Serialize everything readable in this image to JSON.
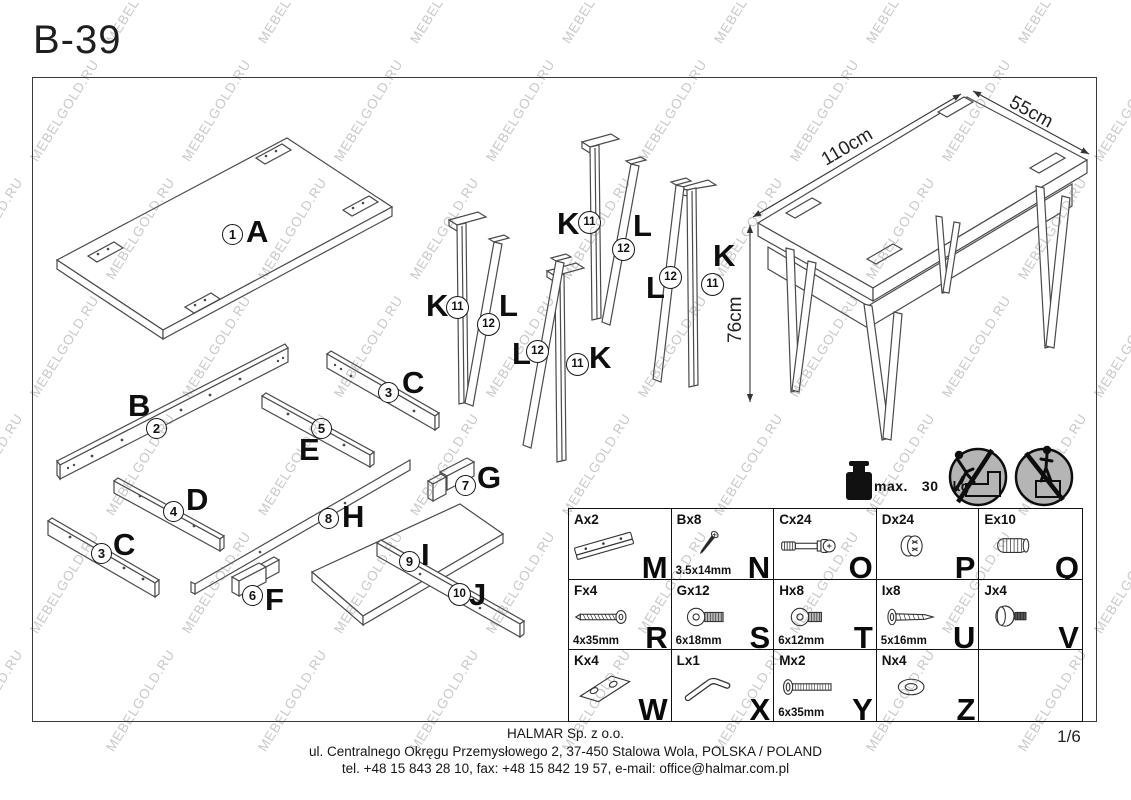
{
  "title": "B-39",
  "page_number": "1/6",
  "watermark_text": "MEBELGOLD.RU",
  "assembled_view": {
    "width_label": "110cm",
    "depth_label": "55cm",
    "height_label": "76cm"
  },
  "weight_limit": {
    "prefix": "max.",
    "value": "30",
    "unit": "kg"
  },
  "part_labels": [
    {
      "letter": "A",
      "number": "1"
    },
    {
      "letter": "B",
      "number": "2"
    },
    {
      "letter": "C",
      "number": "3"
    },
    {
      "letter": "C",
      "number": "3"
    },
    {
      "letter": "D",
      "number": "4"
    },
    {
      "letter": "E",
      "number": "5"
    },
    {
      "letter": "F",
      "number": "6"
    },
    {
      "letter": "G",
      "number": "7"
    },
    {
      "letter": "H",
      "number": "8"
    },
    {
      "letter": "I",
      "number": "9"
    },
    {
      "letter": "J",
      "number": "10"
    },
    {
      "letter": "K",
      "number": "11"
    },
    {
      "letter": "L",
      "number": "12"
    },
    {
      "letter": "L",
      "number": "12"
    },
    {
      "letter": "K",
      "number": "11"
    },
    {
      "letter": "K",
      "number": "11"
    },
    {
      "letter": "L",
      "number": "12"
    },
    {
      "letter": "L",
      "number": "12"
    },
    {
      "letter": "K",
      "number": "11"
    }
  ],
  "hardware": {
    "cells": [
      {
        "code": "Ax2",
        "size": "",
        "letter": "M",
        "icon": "drawer-slide-icon"
      },
      {
        "code": "Bx8",
        "size": "3.5x14mm",
        "letter": "N",
        "icon": "screw-small-icon"
      },
      {
        "code": "Cx24",
        "size": "",
        "letter": "O",
        "icon": "cam-bolt-icon"
      },
      {
        "code": "Dx24",
        "size": "",
        "letter": "P",
        "icon": "cam-lock-icon"
      },
      {
        "code": "Ex10",
        "size": "",
        "letter": "Q",
        "icon": "dowel-icon"
      },
      {
        "code": "Fx4",
        "size": "4x35mm",
        "letter": "R",
        "icon": "screw-long-icon"
      },
      {
        "code": "Gx12",
        "size": "6x18mm",
        "letter": "S",
        "icon": "flange-bolt-icon"
      },
      {
        "code": "Hx8",
        "size": "6x12mm",
        "letter": "T",
        "icon": "flange-bolt-short-icon"
      },
      {
        "code": "Ix8",
        "size": "5x16mm",
        "letter": "U",
        "icon": "pan-screw-icon"
      },
      {
        "code": "Jx4",
        "size": "",
        "letter": "V",
        "icon": "knob-bolt-icon"
      },
      {
        "code": "Kx4",
        "size": "",
        "letter": "W",
        "icon": "plate-icon"
      },
      {
        "code": "Lx1",
        "size": "",
        "letter": "X",
        "icon": "allen-key-icon"
      },
      {
        "code": "Mx2",
        "size": "6x35mm",
        "letter": "Y",
        "icon": "machine-screw-icon"
      },
      {
        "code": "Nx4",
        "size": "",
        "letter": "Z",
        "icon": "washer-icon"
      },
      {
        "code": "",
        "size": "",
        "letter": "",
        "icon": ""
      }
    ]
  },
  "footer": {
    "company": "HALMAR Sp. z o.o.",
    "address": "ul. Centralnego Okręgu Przemysłowego 2, 37-450 Stalowa Wola, POLSKA / POLAND",
    "contact": "tel. +48 15 843 28 10, fax: +48 15 842 19 57, e-mail: office@halmar.com.pl"
  }
}
